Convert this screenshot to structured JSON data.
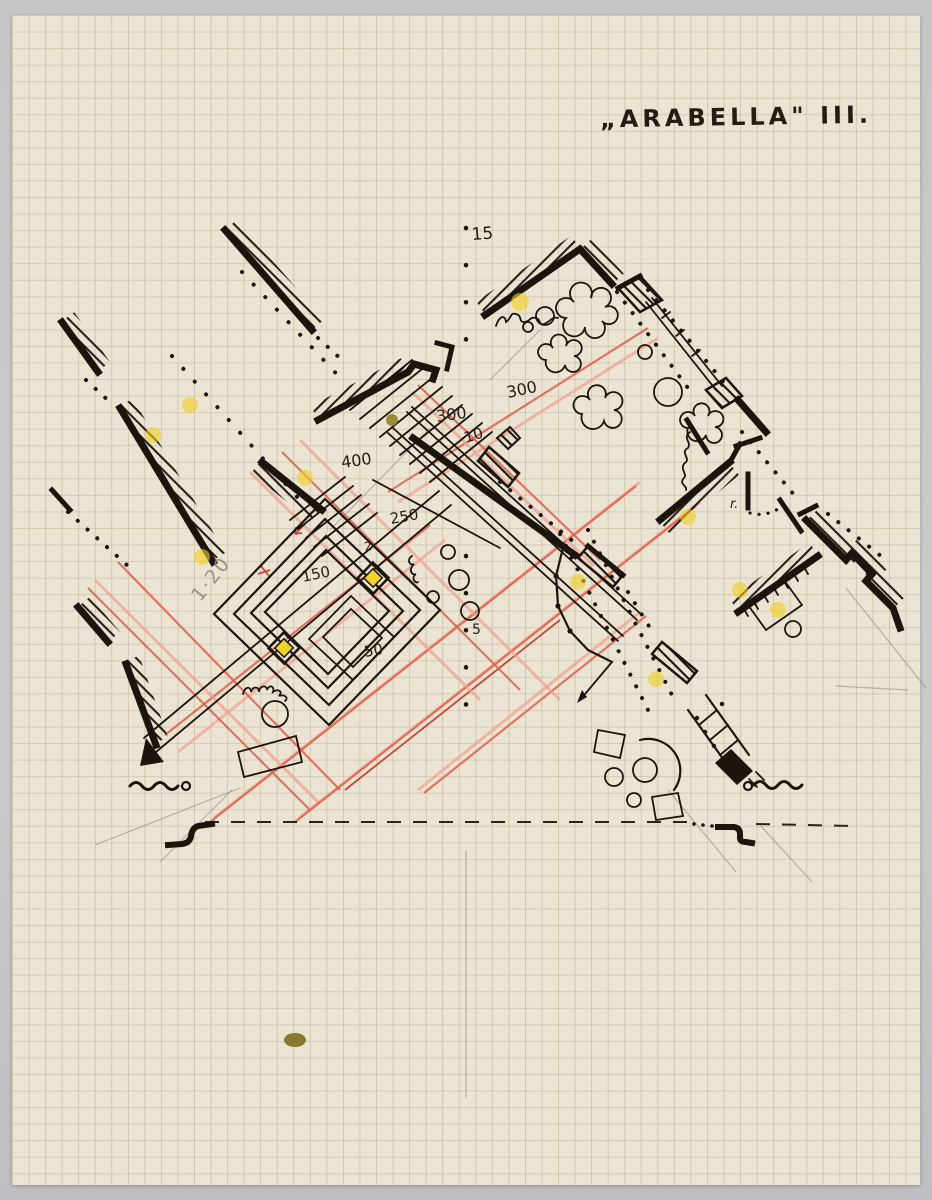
{
  "document": {
    "title": "„ARABELLA\" III."
  },
  "plan": {
    "elevation_labels": {
      "l15": "15",
      "l300a": "300",
      "l300b": "300",
      "l400": "400",
      "l250": "250",
      "l2": "2",
      "l150": "150",
      "l50": "50",
      "l10": "10",
      "l5": "5"
    },
    "notes": {
      "scale": "1·20",
      "room": "r."
    }
  },
  "colors": {
    "backdrop": "#c8c8cb",
    "paper": "#ece4d3",
    "grid_line": "#9e9270",
    "ink": "#1c150d",
    "red_pencil": "#dd5f4b",
    "pink_pencil": "#efa08e",
    "yellow_marker": "#f2cf1f",
    "olive_mark": "#8f7d22"
  }
}
